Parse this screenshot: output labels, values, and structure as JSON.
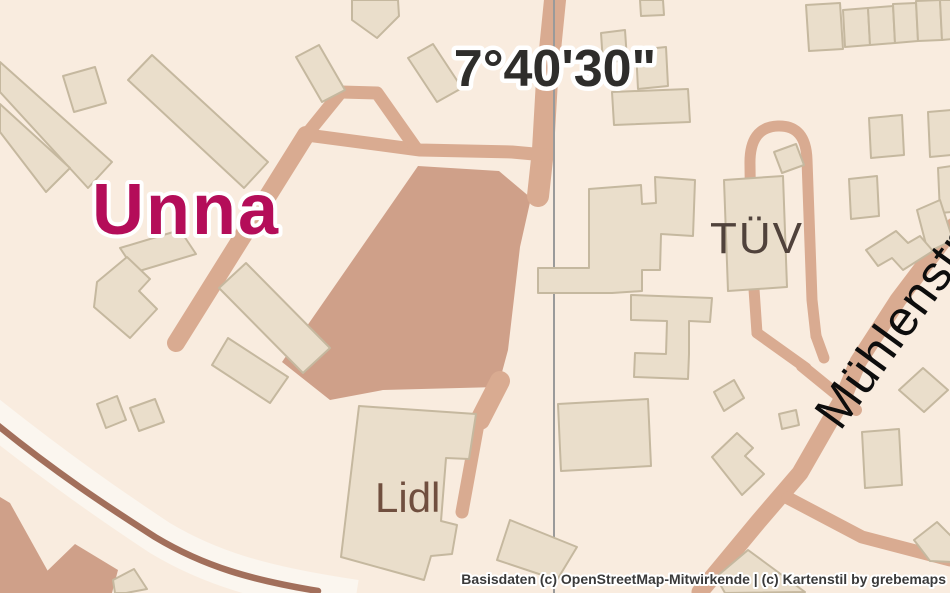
{
  "map": {
    "grid_label": "7°40'30\"",
    "place_label": "Unna",
    "poi_labels": {
      "tuv": "TÜV",
      "lidl": "Lidl"
    },
    "street_label": "Mühlenstraße",
    "attribution": "Basisdaten (c) OpenStreetMap-Mitwirkende | (c) Kartenstil by grebemaps",
    "colors": {
      "background": "#f9ecdf",
      "road": "#d9ab91",
      "parking": "#cfa089",
      "building_fill": "#eadecb",
      "building_stroke": "#c5b89f",
      "railway": "#a26f5b",
      "railway_corridor": "#fbf6ef",
      "graticule": "#9a9a9a",
      "place_color": "#b40d59",
      "poi_color": "#50423b",
      "lidl_color": "#704f3f",
      "street_color": "#0d0d0d",
      "grid_label_color": "#2e2d2b",
      "attribution_color": "#3a3a3a"
    }
  }
}
